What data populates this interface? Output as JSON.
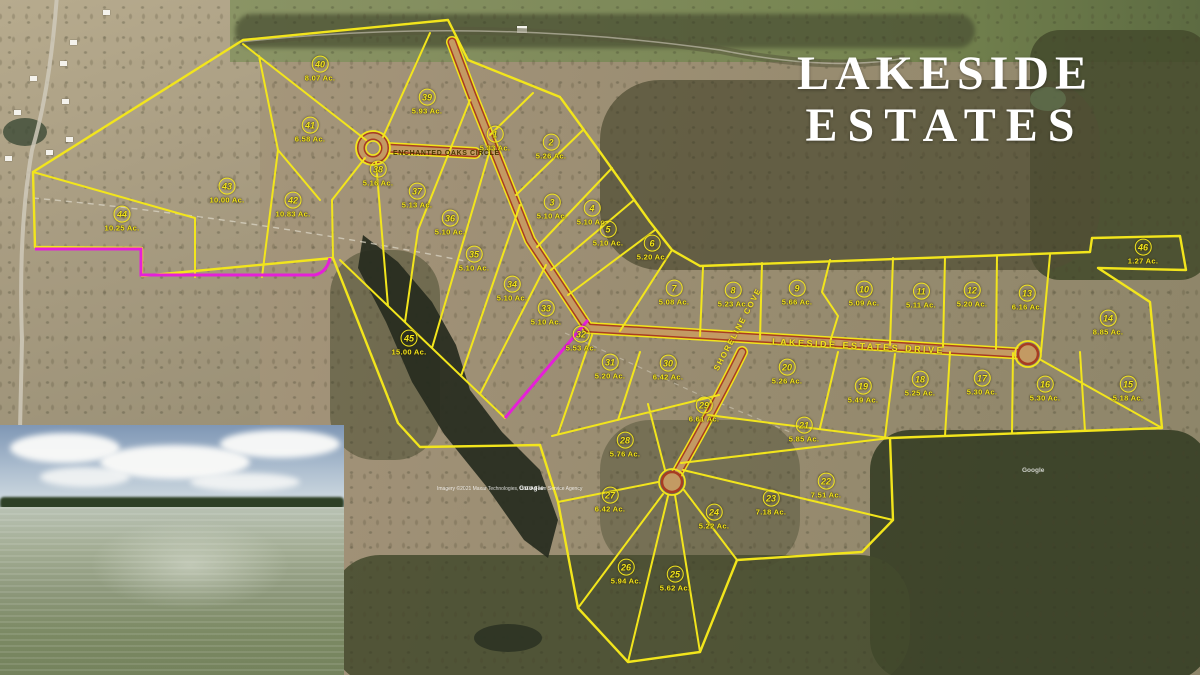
{
  "title": {
    "line1": "LAKESIDE",
    "line2": "ESTATES"
  },
  "road_labels": {
    "enchanted_oaks_circle": "ENCHANTED  OAKS  CIRCLE",
    "lakeside_estates_drive": "LAKESIDE   ESTATES   DRIVE",
    "shoreline_cove": "SHORELINE  COVE"
  },
  "attribution": {
    "imagery_credit": "Imagery ©2021 Maxar Technologies, USDA Farm Service Agency",
    "google_watermark": "Google"
  },
  "colors": {
    "lot_line_yellow": "#f2e51c",
    "road_edge_red": "#a83c22",
    "road_fill_tan": "#c39a63",
    "easement_magenta": "#e520d8",
    "title_white": "#ffffff"
  },
  "lots": [
    {
      "n": "1",
      "acres": "5.33 Ac.",
      "x": 495,
      "y": 138
    },
    {
      "n": "2",
      "acres": "5.26 Ac.",
      "x": 551,
      "y": 146
    },
    {
      "n": "3",
      "acres": "5.10 Ac.",
      "x": 552,
      "y": 206
    },
    {
      "n": "4",
      "acres": "5.10 Ac.",
      "x": 592,
      "y": 212
    },
    {
      "n": "5",
      "acres": "5.10 Ac.",
      "x": 608,
      "y": 233
    },
    {
      "n": "6",
      "acres": "5.20 Ac.",
      "x": 652,
      "y": 247
    },
    {
      "n": "7",
      "acres": "5.08 Ac.",
      "x": 674,
      "y": 292
    },
    {
      "n": "8",
      "acres": "5.23 Ac.",
      "x": 733,
      "y": 294
    },
    {
      "n": "9",
      "acres": "5.66 Ac.",
      "x": 797,
      "y": 292
    },
    {
      "n": "10",
      "acres": "5.09 Ac.",
      "x": 864,
      "y": 293
    },
    {
      "n": "11",
      "acres": "5.11 Ac.",
      "x": 921,
      "y": 295
    },
    {
      "n": "12",
      "acres": "5.20 Ac.",
      "x": 972,
      "y": 294
    },
    {
      "n": "13",
      "acres": "6.16 Ac.",
      "x": 1027,
      "y": 297
    },
    {
      "n": "14",
      "acres": "8.85 Ac.",
      "x": 1108,
      "y": 322
    },
    {
      "n": "15",
      "acres": "5.18 Ac.",
      "x": 1128,
      "y": 388
    },
    {
      "n": "16",
      "acres": "5.30 Ac.",
      "x": 1045,
      "y": 388
    },
    {
      "n": "17",
      "acres": "5.30 Ac.",
      "x": 982,
      "y": 382
    },
    {
      "n": "18",
      "acres": "5.25 Ac.",
      "x": 920,
      "y": 383
    },
    {
      "n": "19",
      "acres": "5.49 Ac.",
      "x": 863,
      "y": 390
    },
    {
      "n": "20",
      "acres": "5.26 Ac.",
      "x": 787,
      "y": 371
    },
    {
      "n": "21",
      "acres": "5.85 Ac.",
      "x": 804,
      "y": 429
    },
    {
      "n": "22",
      "acres": "7.51 Ac.",
      "x": 826,
      "y": 485
    },
    {
      "n": "23",
      "acres": "7.18 Ac.",
      "x": 771,
      "y": 502
    },
    {
      "n": "24",
      "acres": "5.22 Ac.",
      "x": 714,
      "y": 516
    },
    {
      "n": "25",
      "acres": "5.62 Ac.",
      "x": 675,
      "y": 578
    },
    {
      "n": "26",
      "acres": "5.94 Ac.",
      "x": 626,
      "y": 571
    },
    {
      "n": "27",
      "acres": "6.42 Ac.",
      "x": 610,
      "y": 499
    },
    {
      "n": "28",
      "acres": "5.76 Ac.",
      "x": 625,
      "y": 444
    },
    {
      "n": "29",
      "acres": "6.61 Ac.",
      "x": 704,
      "y": 409
    },
    {
      "n": "30",
      "acres": "6.42 Ac.",
      "x": 668,
      "y": 367
    },
    {
      "n": "31",
      "acres": "5.20 Ac.",
      "x": 610,
      "y": 366
    },
    {
      "n": "32",
      "acres": "5.53 Ac.",
      "x": 581,
      "y": 338
    },
    {
      "n": "33",
      "acres": "5.10 Ac.",
      "x": 546,
      "y": 312
    },
    {
      "n": "34",
      "acres": "5.10 Ac.",
      "x": 512,
      "y": 288
    },
    {
      "n": "35",
      "acres": "5.10 Ac.",
      "x": 474,
      "y": 258
    },
    {
      "n": "36",
      "acres": "5.10 Ac.",
      "x": 450,
      "y": 222
    },
    {
      "n": "37",
      "acres": "5.13 Ac.",
      "x": 417,
      "y": 195
    },
    {
      "n": "38",
      "acres": "5.16 Ac.",
      "x": 378,
      "y": 173
    },
    {
      "n": "39",
      "acres": "5.93 Ac.",
      "x": 427,
      "y": 101
    },
    {
      "n": "40",
      "acres": "8.07 Ac.",
      "x": 320,
      "y": 68
    },
    {
      "n": "41",
      "acres": "6.58 Ac.",
      "x": 310,
      "y": 129
    },
    {
      "n": "42",
      "acres": "10.83 Ac.",
      "x": 293,
      "y": 204
    },
    {
      "n": "43",
      "acres": "10.00 Ac.",
      "x": 227,
      "y": 190
    },
    {
      "n": "44",
      "acres": "10.25 Ac.",
      "x": 122,
      "y": 218
    },
    {
      "n": "45",
      "acres": "15.00 Ac.",
      "x": 409,
      "y": 342
    },
    {
      "n": "46",
      "acres": "1.27 Ac.",
      "x": 1143,
      "y": 251
    }
  ]
}
